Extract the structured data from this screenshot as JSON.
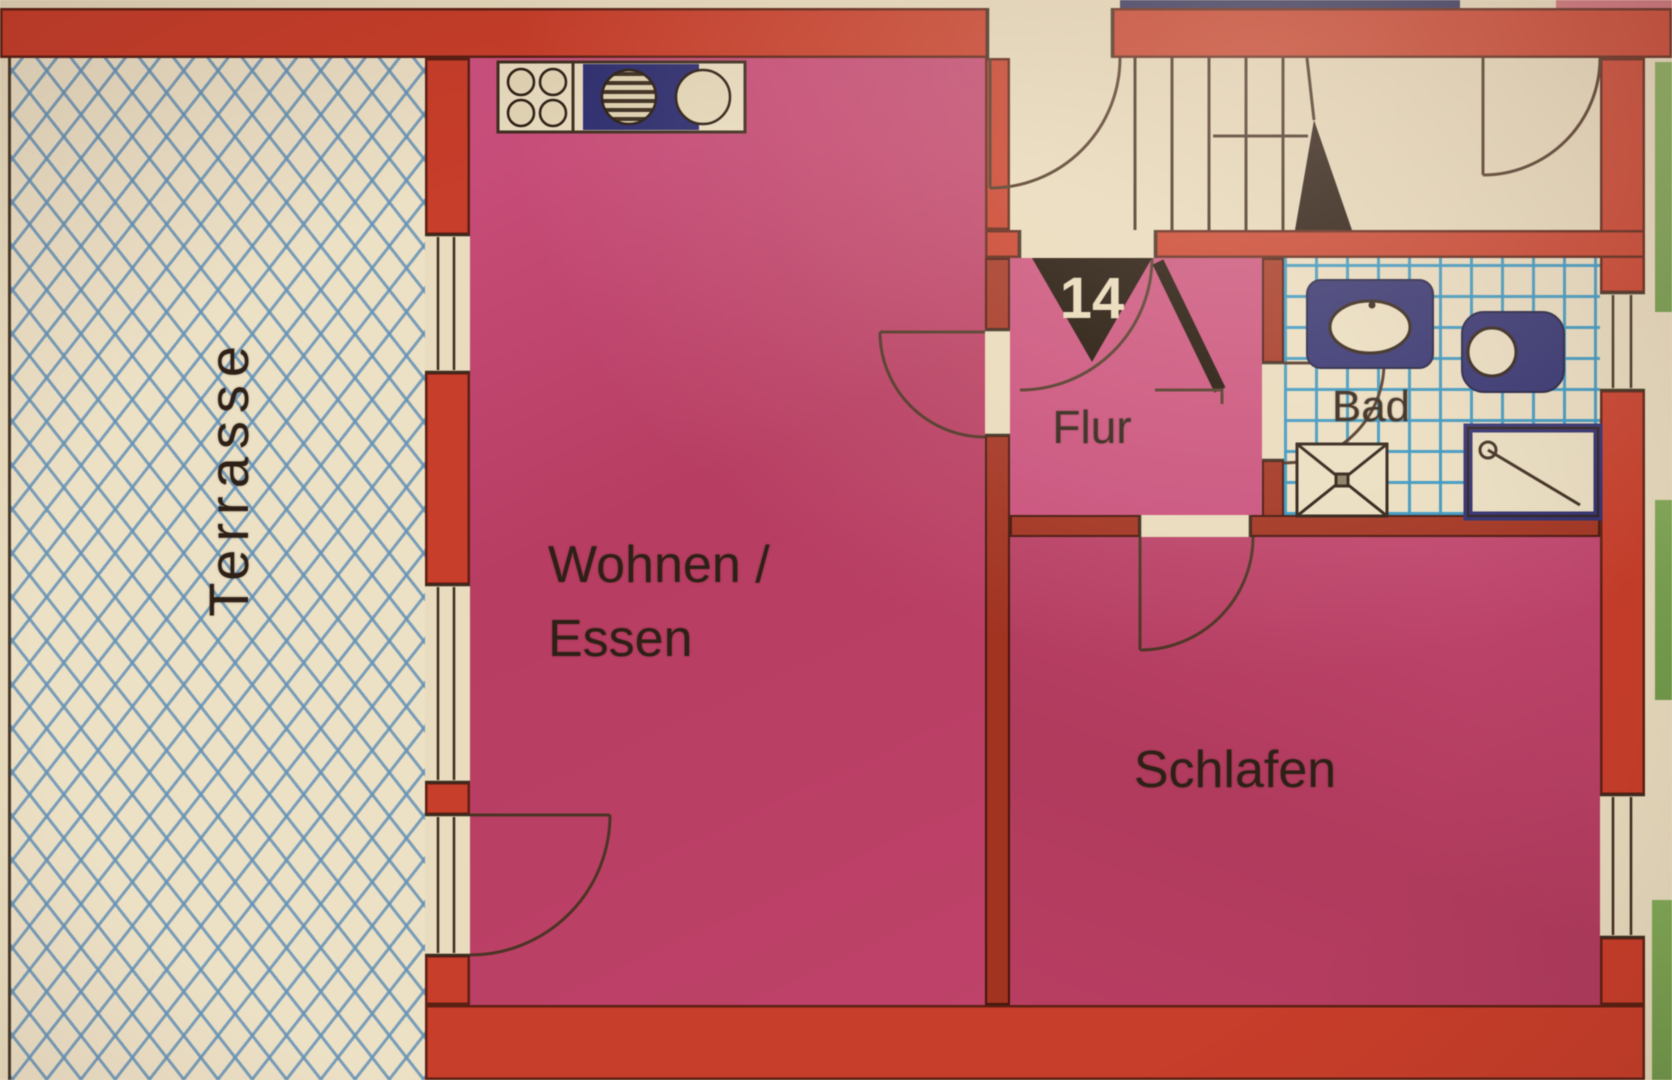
{
  "plan": {
    "type": "floor-plan",
    "apartment_number": "14",
    "rooms": [
      {
        "id": "terrasse",
        "label": "Terrasse"
      },
      {
        "id": "wohnen-essen",
        "label_line1": "Wohnen /",
        "label_line2": "Essen"
      },
      {
        "id": "flur",
        "label": "Flur"
      },
      {
        "id": "bad",
        "label": "Bad"
      },
      {
        "id": "schlafen",
        "label": "Schlafen"
      }
    ],
    "fixtures": [
      "stove",
      "kitchen-sink",
      "washbasin",
      "toilet",
      "bathtub",
      "shower",
      "staircase"
    ],
    "colors": {
      "paper": "#e9dcbd",
      "wall_exterior": "#cc3d28",
      "wall_interior": "#a5321f",
      "room_pink": "#c24068",
      "flur_pink": "#cd4f7d",
      "schlafen_pink": "#b93d62",
      "fixture_navy": "#2c2d72",
      "tile_blue": "#2f95c5",
      "lattice_blue": "#6392b8",
      "outside_green": "#75a24b",
      "line_dark": "#3c2b1c",
      "label_text": "#2e2015",
      "entrance_marker_black": "#190e04",
      "marker_number_cream": "#e7dbbc"
    }
  }
}
